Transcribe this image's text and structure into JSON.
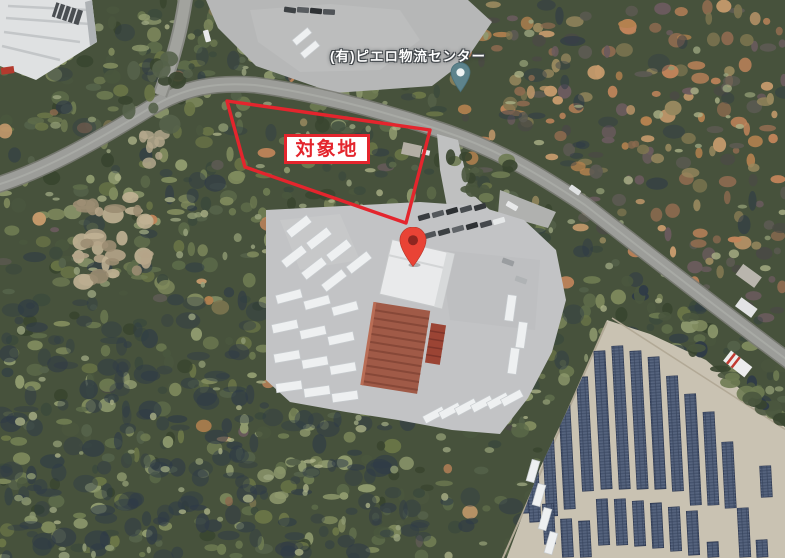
{
  "map": {
    "annotations": {
      "site_label": "対象地"
    },
    "places": {
      "logistics_center_label": "(有)ピエロ物流センター"
    },
    "colors": {
      "site_outline_red": "#e4252d",
      "marker_red": "#e94335",
      "marker_red_dot": "#8e2620",
      "marker_teal": "#5d838c",
      "marker_teal_dot": "#eef3f3"
    }
  }
}
